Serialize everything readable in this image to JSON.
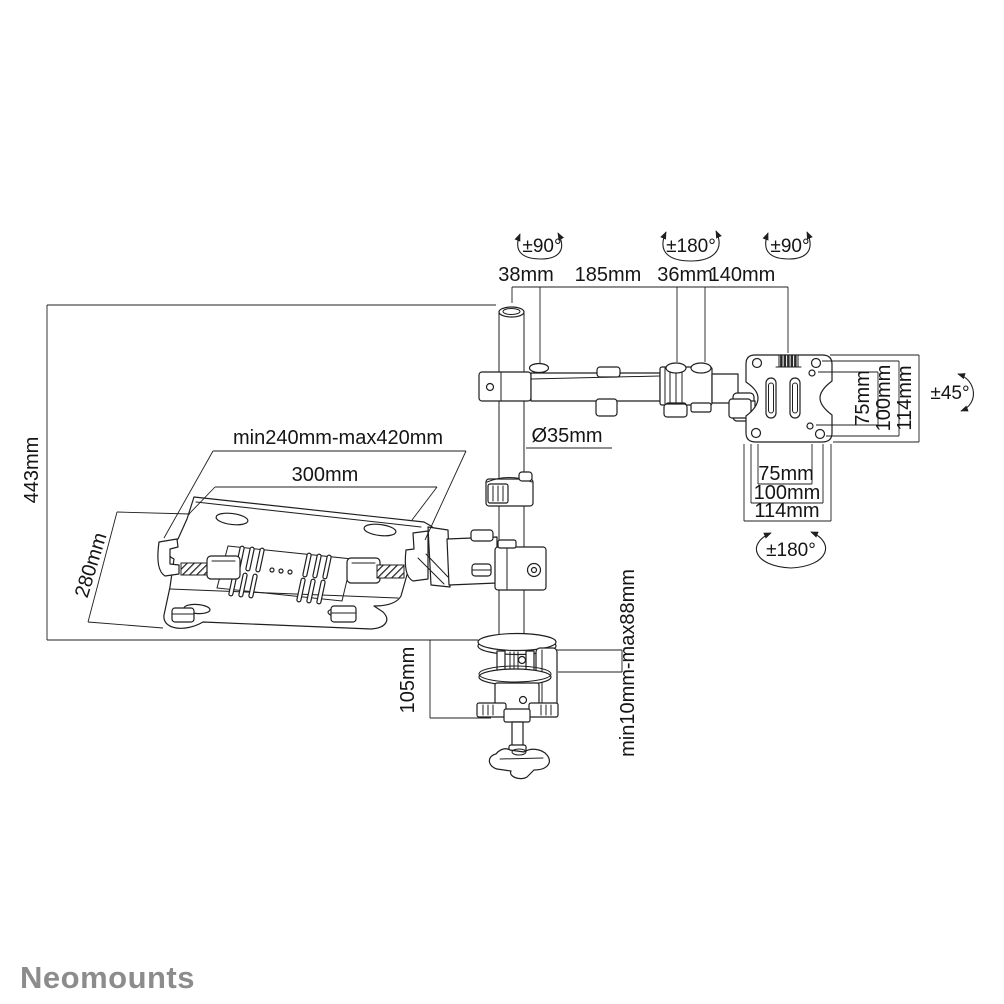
{
  "colors": {
    "ink": "#1f1f1f",
    "logo_gray": "#8c8c8c",
    "background": "#ffffff"
  },
  "logo": {
    "text": "Neomounts"
  },
  "dims": {
    "top": {
      "rot_pole": "±90°",
      "rot_elbow": "±180°",
      "rot_screen": "±90°",
      "seg_38": "38mm",
      "seg_185": "185mm",
      "seg_36": "36mm",
      "seg_140": "140mm"
    },
    "vesa": {
      "v75": "75mm",
      "v100": "100mm",
      "v114": "114mm",
      "h75": "75mm",
      "h100": "100mm",
      "h114": "114mm",
      "tilt": "±45°",
      "rotate": "±180°"
    },
    "pole": {
      "diameter": "Ø35mm",
      "height": "443mm"
    },
    "tray": {
      "range": "min240mm-max420mm",
      "width": "300mm",
      "depth": "280mm"
    },
    "clamp": {
      "below_desk": "105mm",
      "desk_thickness": "min10mm-max88mm"
    }
  }
}
